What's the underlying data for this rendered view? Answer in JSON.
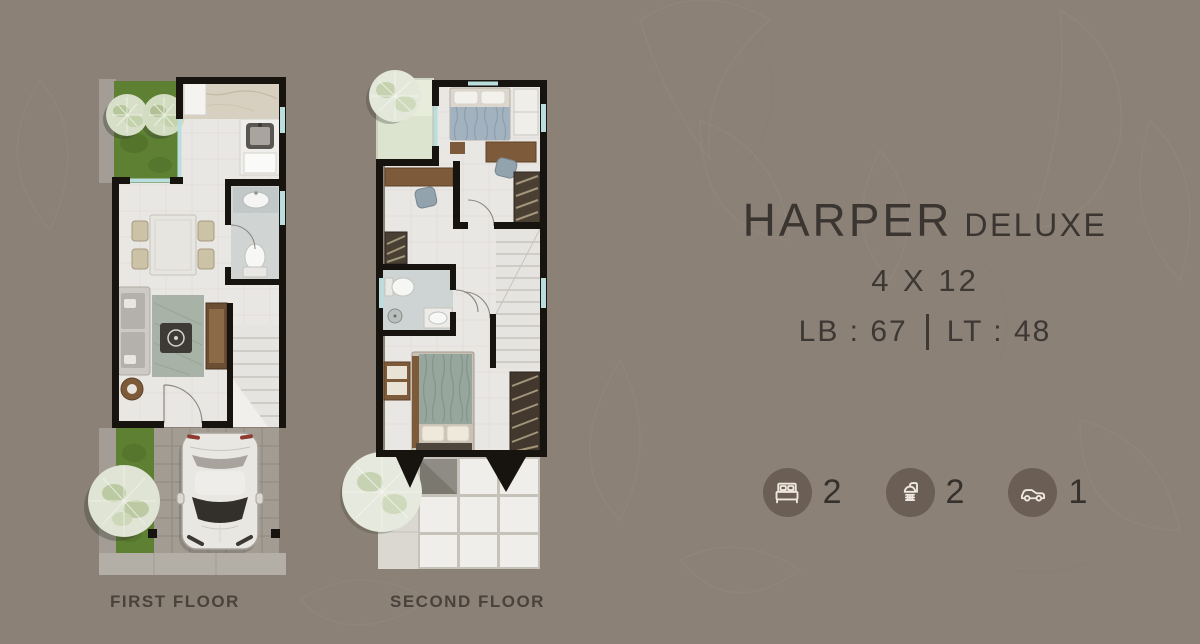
{
  "header": {
    "title": "HARPER",
    "title_suffix": "DELUXE",
    "dimensions": "4 X 12",
    "building_area": "LB : 67",
    "land_area": "LT : 48"
  },
  "stats": [
    {
      "icon": "bed-icon",
      "value": "2"
    },
    {
      "icon": "shower-icon",
      "value": "2"
    },
    {
      "icon": "car-icon",
      "value": "1"
    }
  ],
  "floors": [
    {
      "label": "FIRST FLOOR"
    },
    {
      "label": "SECOND FLOOR"
    }
  ],
  "colors": {
    "background": "#8c8177",
    "text": "#3a3530",
    "icon_circle": "#6b5e54",
    "icon_glyph": "#efe8e0",
    "wall": "#17140f",
    "grass": "#5d8032",
    "floor": "#e9e7e4",
    "glass": "#b9dedd",
    "wood": "#7d5b3a"
  }
}
